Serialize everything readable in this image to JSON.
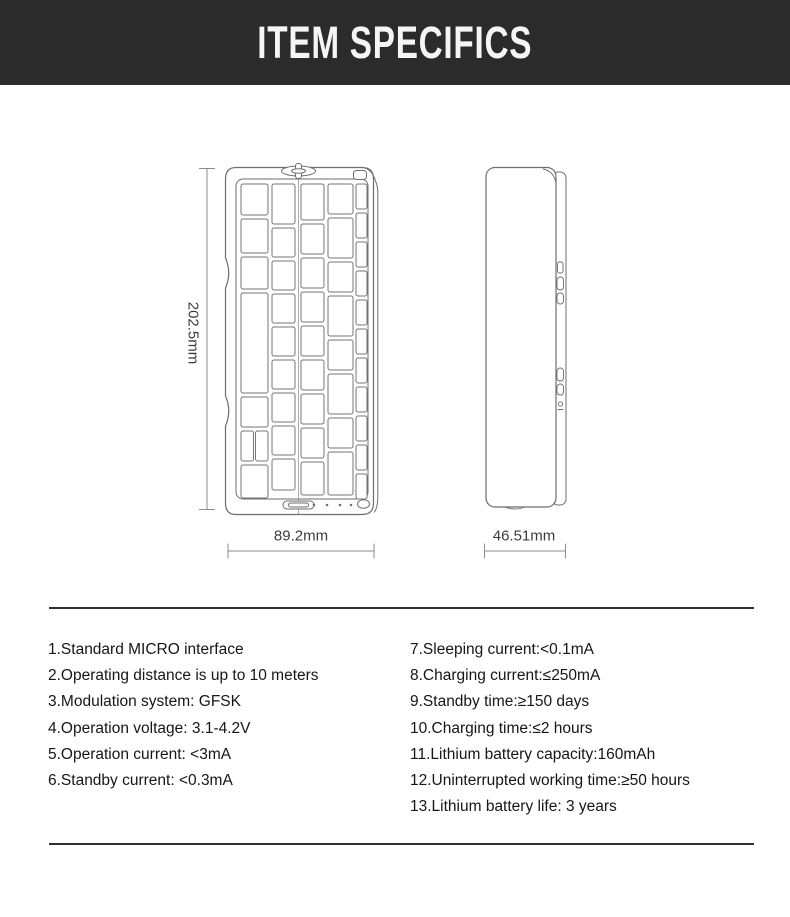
{
  "header": {
    "title": "ITEM SPECIFICS"
  },
  "diagram": {
    "keyboard_height_label": "202.5mm",
    "keyboard_width_label": "89.2mm",
    "side_width_label": "46.51mm"
  },
  "specs": {
    "left": [
      "1.Standard MICRO interface",
      "2.Operating distance is up to 10 meters",
      "3.Modulation system: GFSK",
      "4.Operation voltage: 3.1-4.2V",
      "5.Operation current: <3mA",
      "6.Standby current: <0.3mA"
    ],
    "right": [
      "7.Sleeping current:<0.1mA",
      "8.Charging current:≤250mA",
      "9.Standby time:≥150 days",
      "10.Charging time:≤2 hours",
      "11.Lithium battery capacity:160mAh",
      "12.Uninterrupted working time:≥50 hours",
      "13.Lithium battery life: 3 years"
    ]
  },
  "colors": {
    "header_bg": "#2b2b2b",
    "header_text": "#f5f5f5",
    "drawing_line": "#6e6e6e",
    "dimension_line": "#8c8c8c",
    "body_text": "#161616"
  }
}
